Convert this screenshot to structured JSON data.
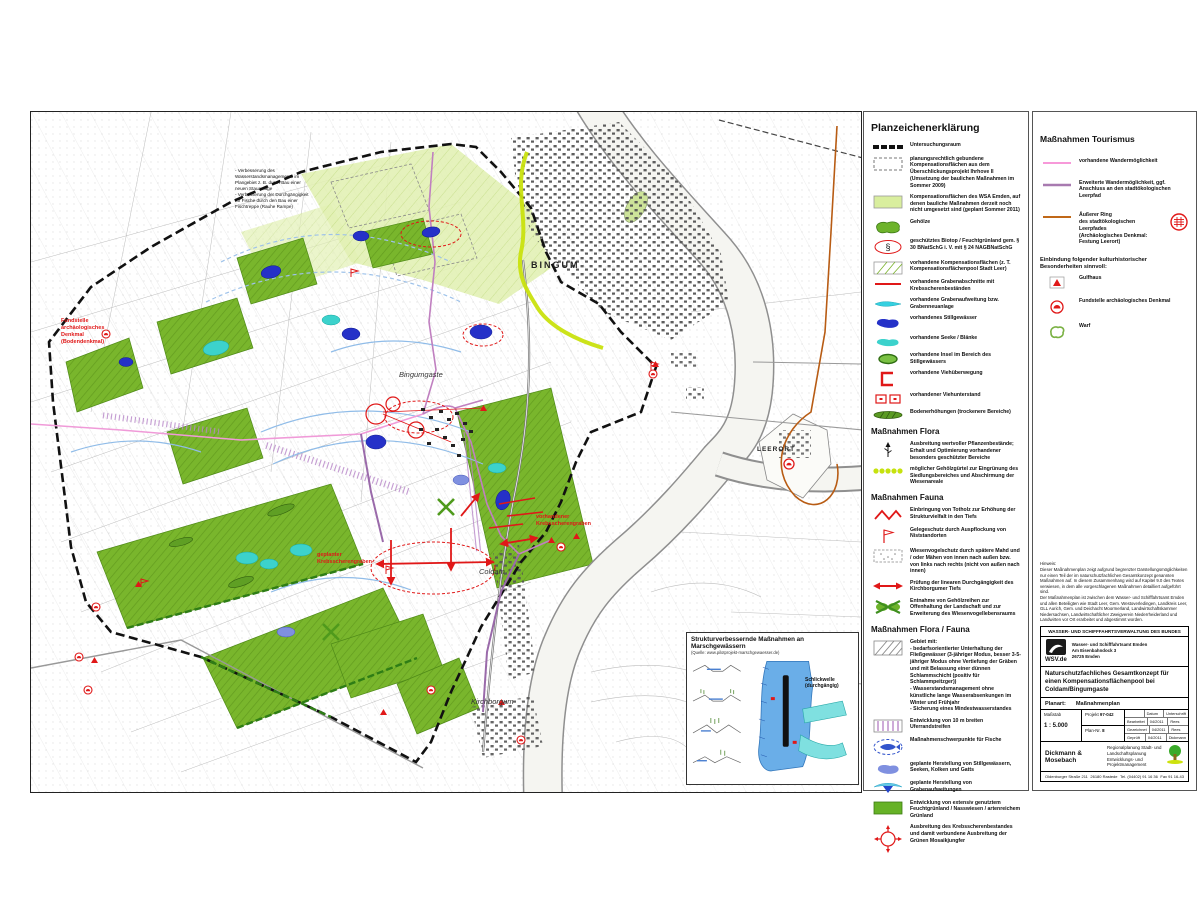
{
  "map": {
    "labels": {
      "bingum": "BINGUM",
      "bingumgaste": "Bingumgaste",
      "coldam": "Coldam",
      "kirchborgum": "Kirchborgum",
      "leerort": "LEERORT",
      "annotation_nw": "Fundstelle\narchäologisches\nDenkmal\n(Bodendenkmal)",
      "annotation_planned_ditch": "geplanter\nKrebsscherengraben",
      "annotation_existing_ditch": "vorhandener\nKrebsscherengraben",
      "annotation_weir": "- Verbesserung des Wasserstandsmanagements im Plangebiet z. B. durch Bau einer neuen Stauanlage\n- Verbesserung der Durchgängigkeit für Fische durch den Bau einer Fischtreppe (Rauhe Rampe)"
    },
    "inset": {
      "title": "Strukturverbessernde Maßnahmen an Marschgewässern",
      "source": "(Quelle: www.pilotprojekt-marschgewaesser.de)",
      "schlickwelle": "Schlickwelle\n(durchgängig)"
    }
  },
  "legend1": {
    "title": "Planzeichenerklärung",
    "items": [
      {
        "label": "Untersuchungsraum"
      },
      {
        "label": "planungsrechtlich gebundene Kompensationsflächen aus dem Überschlickungsprojekt Ihrhove II (Umsetzung der baulichen Maßnahmen im Sommer 2009)"
      },
      {
        "label": "Kompensationsflächen des WSA Emden, auf denen bauliche Maßnahmen derzeit noch nicht umgesetzt sind (geplant Sommer 2011)"
      },
      {
        "label": "Gehölze"
      },
      {
        "label": "geschütztes Biotop / Feuchtgrünland gem. § 30 BNatSchG i. V. mit § 24 NAGBNatSchG"
      },
      {
        "label": "vorhandene Kompensationsflächen (z. T. Kompensationsflächenpool Stadt Leer)"
      },
      {
        "label": "vorhandene Grabenabschnitte mit Krebsscherenbeständen"
      },
      {
        "label": "vorhandene Grabenaufweitung bzw. Grabenneuanlage"
      },
      {
        "label": "vorhandenes Stillgewässer"
      },
      {
        "label": "vorhandene Seeke / Blänke"
      },
      {
        "label": "vorhandene Insel im Bereich des Stillgewässers"
      },
      {
        "label": "vorhandene Viehüberwegung"
      },
      {
        "label": "vorhandener Viehunterstand"
      },
      {
        "label": "Bodenerhöhungen (trockenere Bereiche)"
      }
    ],
    "paragraph_sign": "§",
    "flora": {
      "title": "Maßnahmen Flora",
      "items": [
        {
          "label": "Ausbreitung wertvoller Pflanzenbestände; Erhalt und Optimierung vorhandener besonders geschützter Bereiche"
        },
        {
          "label": "möglicher Gehölzgürtel zur Eingrünung des Siedlungsbereiches und Abschirmung der Wiesenareale"
        }
      ]
    },
    "fauna": {
      "title": "Maßnahmen Fauna",
      "items": [
        {
          "label": "Einbringung von Totholz zur Erhöhung der Strukturvielfalt in den Tiefs"
        },
        {
          "label": "Gelegeschutz durch Auspflockung von Niststandorten"
        },
        {
          "label": "Wiesenvogelschutz durch spätere Mahd und / oder Mähen von innen nach außen bzw. von links nach rechts (nicht von außen nach innen)"
        },
        {
          "label": "Prüfung der linearen Durchgängigkeit des Kirchborgumer Tiefs"
        },
        {
          "label": "Entnahme von Gehölzreihen zur Offenhaltung der Landschaft und zur Erweiterung des Wiesenvogellebensraums"
        }
      ]
    },
    "florafauna": {
      "title": "Maßnahmen Flora / Fauna",
      "items": [
        {
          "label": "Gebiet mit:\n- bedarfsorientierter Unterhaltung der Fließgewässer (3-jähriger Modus, besser 3-5-jähriger Modus ohne Vertiefung der Gräben und mit Belassung einer dünnen Schlammschicht (positiv für Schlammpeitzger))\n- Wasserstandsmanagement ohne künstliche lange Wasserabsenkungen im Winter und Frühjahr\n- Sicherung eines Mindestwasserstandes"
        },
        {
          "label": "Entwicklung von 10 m breiten Uferrandstreifen"
        },
        {
          "label": "Maßnahmenschwerpunkte für Fische"
        },
        {
          "label": "geplante Herstellung von Stillgewässern, Seeken, Kolken und Gatts"
        },
        {
          "label": "geplante Herstellung von Grabenaufweitungen"
        },
        {
          "label": "Entwicklung von extensiv genutztem Feuchtgrünland / Nasswiesen / artenreichem Grünland"
        },
        {
          "label": "Ausbreitung des Krebsscherenbestandes und damit verbundene Ausbreitung der Grünen Mosaikjungfer"
        }
      ]
    }
  },
  "legend2": {
    "title": "Maßnahmen Tourismus",
    "items": [
      {
        "label": "vorhandene Wandermöglichkeit"
      },
      {
        "label": "Erweiterte Wandermöglichkeit, ggf. Anschluss an den stadtökologischen Leerpfad"
      },
      {
        "label": "Äußerer Ring\ndes stadtökologischen Leerpfades\n(Archäologisches Denkmal: Festung Leerort)"
      }
    ],
    "heading2": "Einbindung folgender kulturhistorischer Besonderheiten sinnvoll:",
    "items2": [
      {
        "label": "Gulfhaus"
      },
      {
        "label": "Fundstelle archäologisches Denkmal"
      },
      {
        "label": "Warf"
      }
    ]
  },
  "titleblock": {
    "hinweis": "Hinweis:\nDieser Maßnahmenplan zeigt aufgrund begrenzter Darstellungsmöglichkeiten nur einen Teil der im naturschutzfachlichen Gesamtkonzept genannten Maßnahmen auf. In diesem Zusammenhang wird auf Kapitel 9.0 des Textes verwiesen, in dem alle vorgeschlagenen Maßnahmen detailliert aufgeführt sind.\nDer Maßnahmenplan ist zwischen dem Wasser- und Schifffahrtsamt Emden und allen Beteiligten wie Stadt Leer, Gem. Westoverledingen, Landkreis Leer, GLL Aurich, Gem. und Deichacht Moormerland, Landwirtschaftskammer Niedersachsen, Landwirtschaftlicher Zweigverein Niederrheiderland und Landwirten vor Ort erarbeitet und abgestimmt worden.",
    "agency_header": "WASSER- UND SCHIFFFAHRTSVERWALTUNG DES BUNDES",
    "wsv_label": "WSV.de",
    "agency_address": "Wasser- und Schifffahrtsamt Emden\nAm Eisenbahndock 3\n26725 Emden",
    "project_title": "Naturschutzfachliches Gesamtkonzept für einen Kompensationsflächenpool bei Coldam/Bingumgaste",
    "planart_label": "Planart:",
    "planart_value": "Maßnahmenplan",
    "massstab_label": "Maßstab",
    "massstab_value": "1 : 5.000",
    "projekt_label": "Projekt",
    "projekt_value": "97-042",
    "plannr_label": "Plan-Nr.",
    "plannr_value": "8",
    "col_datum": "Datum",
    "col_unterschrift": "Unterschrift",
    "rows": [
      {
        "name": "Bearbeitet",
        "date": "04/2011",
        "sign": "Rees"
      },
      {
        "name": "Gezeichnet",
        "date": "04/2011",
        "sign": "Rees"
      },
      {
        "name": "Geprüft",
        "date": "04/2011",
        "sign": "Dickmann"
      }
    ],
    "firm": "Dickmann & Mosebach",
    "firm_desc": "Regionalplanung Stadt- und Landschaftsplanung\nEntwicklungs- und Projektmanagement",
    "footer_addr": "Oldenburger Straße 211",
    "footer_city": "26180 Rastede",
    "footer_tel": "Tel. (04402) 91 16 36",
    "footer_fax": "Fax 91 16-43"
  }
}
